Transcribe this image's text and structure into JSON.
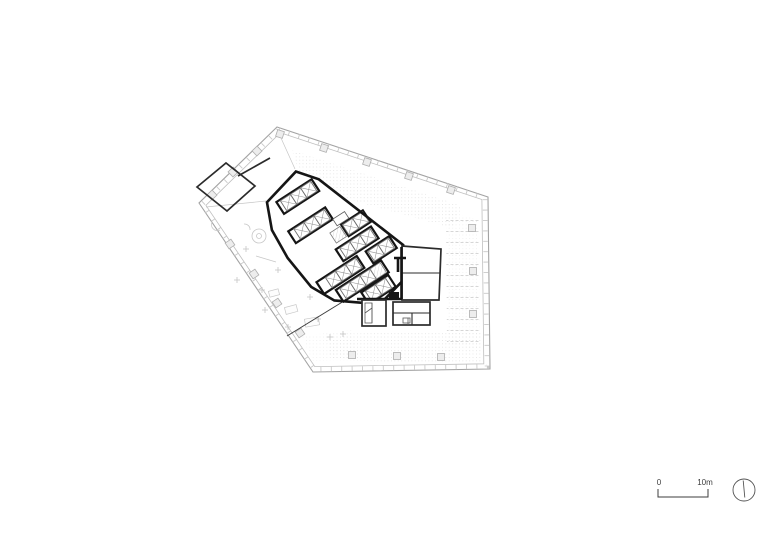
{
  "drawing": {
    "kind": "architectural-floor-plan",
    "scale_bar": {
      "start_label": "0",
      "end_label": "10m"
    },
    "icons": {
      "north_arrow": "compass-circle-icon"
    },
    "colors": {
      "facade": "#a3a3a3",
      "wall_heavy": "#151515",
      "wall_medium": "#2b2b2b",
      "wall_thin": "#5a5a5a",
      "texture": "#d9d9d9",
      "furniture": "#c7c7c7",
      "annotation": "#3c3c3c",
      "background": "#ffffff"
    }
  }
}
